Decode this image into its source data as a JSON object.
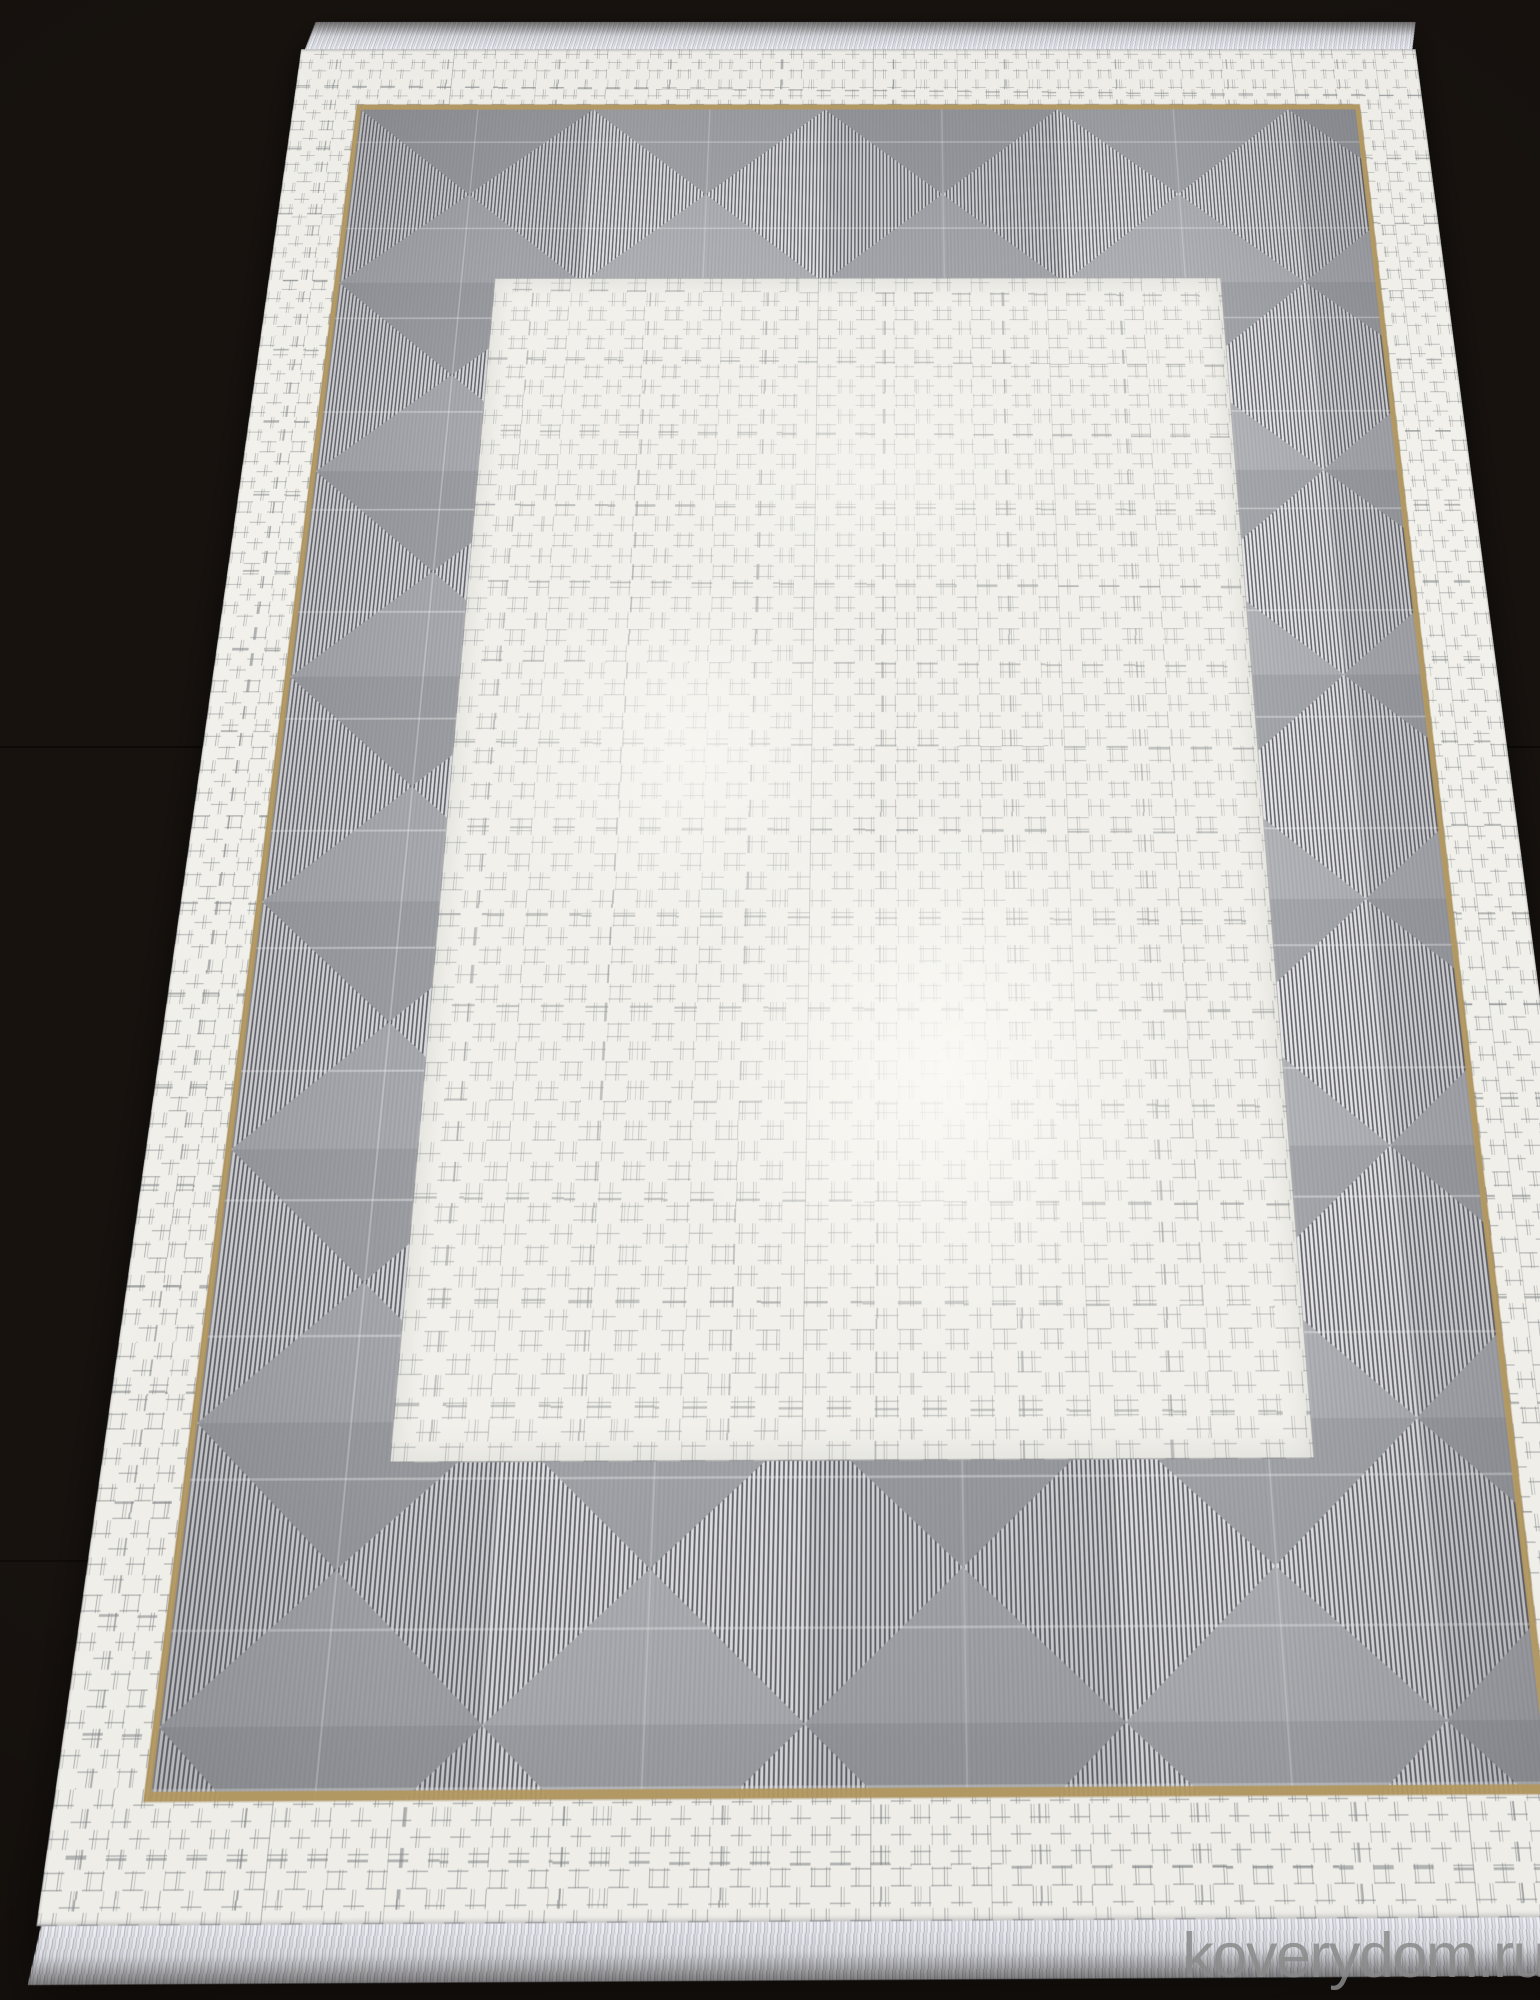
{
  "scene": {
    "subject": "Rectangular cream and gray area rug with a geometric striped-triangle border, photographed at an angle on a dark wood floor",
    "floor_color": "#1a1510",
    "rug": {
      "field_color": "#f1f0ea",
      "band_gray": "#a7a9ad",
      "stripe_dark": "#585960",
      "stripe_light": "#e9e9ec",
      "accent_gold": "#b2975f",
      "fringe_color": "#e9eaef"
    }
  },
  "watermark": {
    "text": "koverydom.ru",
    "color": "#8a8a8a"
  }
}
